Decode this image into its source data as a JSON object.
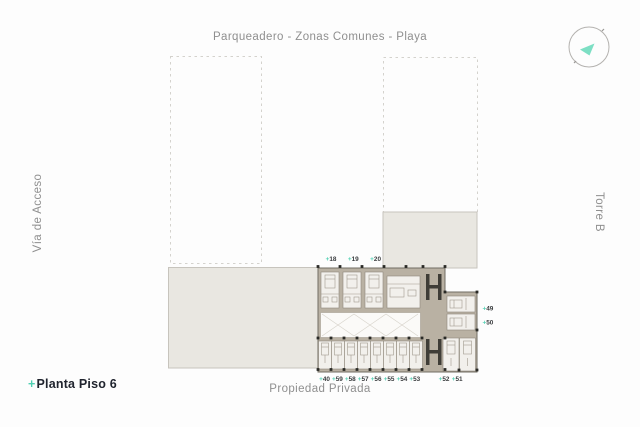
{
  "labels": {
    "top": "Parqueadero - Zonas Comunes - Playa",
    "left": "Vía de Acceso",
    "right": "Torre B",
    "bottom": "Propiedad Privada",
    "title_prefix": "+",
    "title": "Planta Piso 6"
  },
  "plan": {
    "unit_prefix": "+",
    "top_units": [
      "18",
      "19",
      "20"
    ],
    "bottom_units_left": [
      "40",
      "59",
      "58",
      "57",
      "56",
      "55",
      "54",
      "53"
    ],
    "bottom_units_right": [
      "52",
      "51"
    ],
    "right_units": [
      "49",
      "50"
    ]
  },
  "colors": {
    "background": "#fdfdfd",
    "muted_text": "#8f8f8f",
    "title_text": "#20242e",
    "accent": "#4fd0b2",
    "accent_light": "#7ddfc4",
    "slab_beige": "#e9e7e1",
    "wall_taupe": "#b9b1a3"
  },
  "icons": {
    "compass": "north-arrow"
  }
}
